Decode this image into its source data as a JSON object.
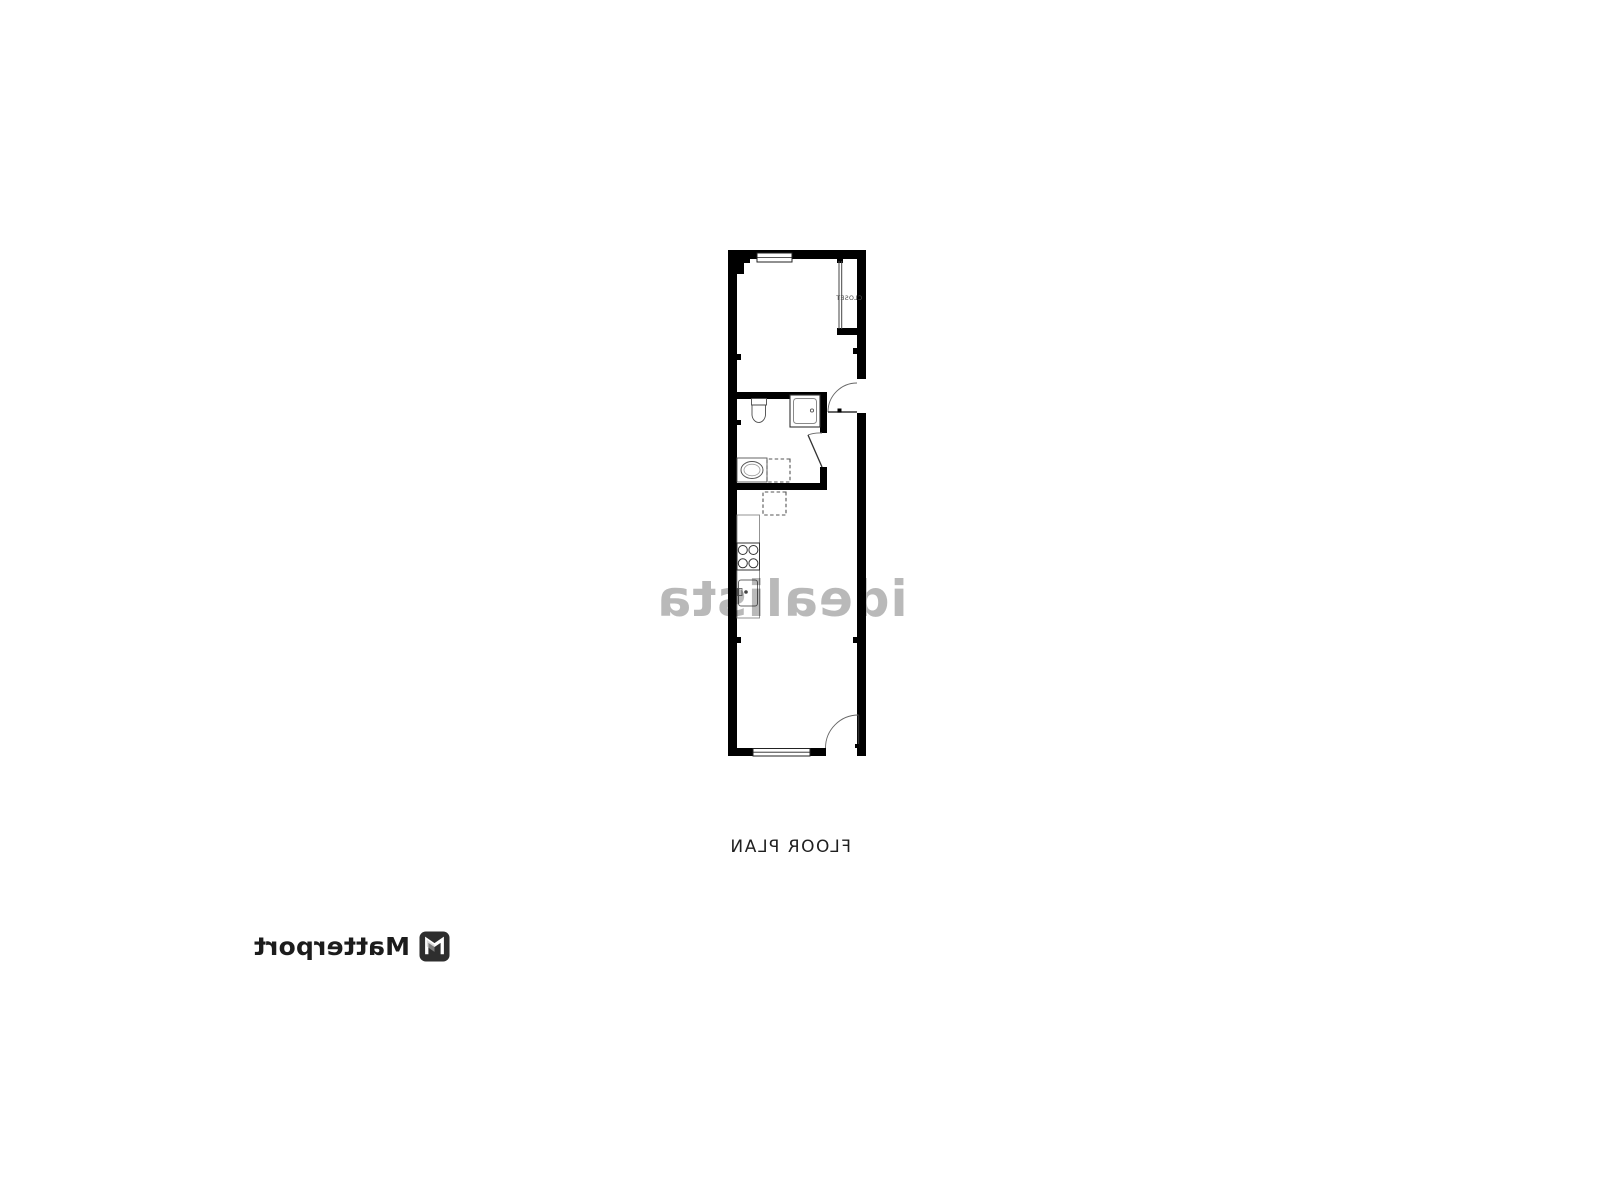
{
  "page": {
    "background_color": "#ffffff",
    "orientation": "mirrored-horizontally"
  },
  "floor_plan": {
    "title": "FLOOR PLAN",
    "wall_color": "#000000",
    "fixture_line_color": "#4a4a4a",
    "rooms": {
      "closet_label": "CLOSET"
    },
    "features": [
      "top window",
      "closet with sliding door",
      "entry door with swing arc",
      "bathroom with shower, toilet, sink, dashed appliance box",
      "kitchen counter with 4-burner stove and sink unit",
      "second dashed appliance box",
      "bottom window",
      "bottom door with swing arc"
    ]
  },
  "watermark": {
    "text": "idealista",
    "color": "#808080"
  },
  "branding": {
    "name": "Matterport",
    "logo_icon": "matterport-cube-icon"
  }
}
